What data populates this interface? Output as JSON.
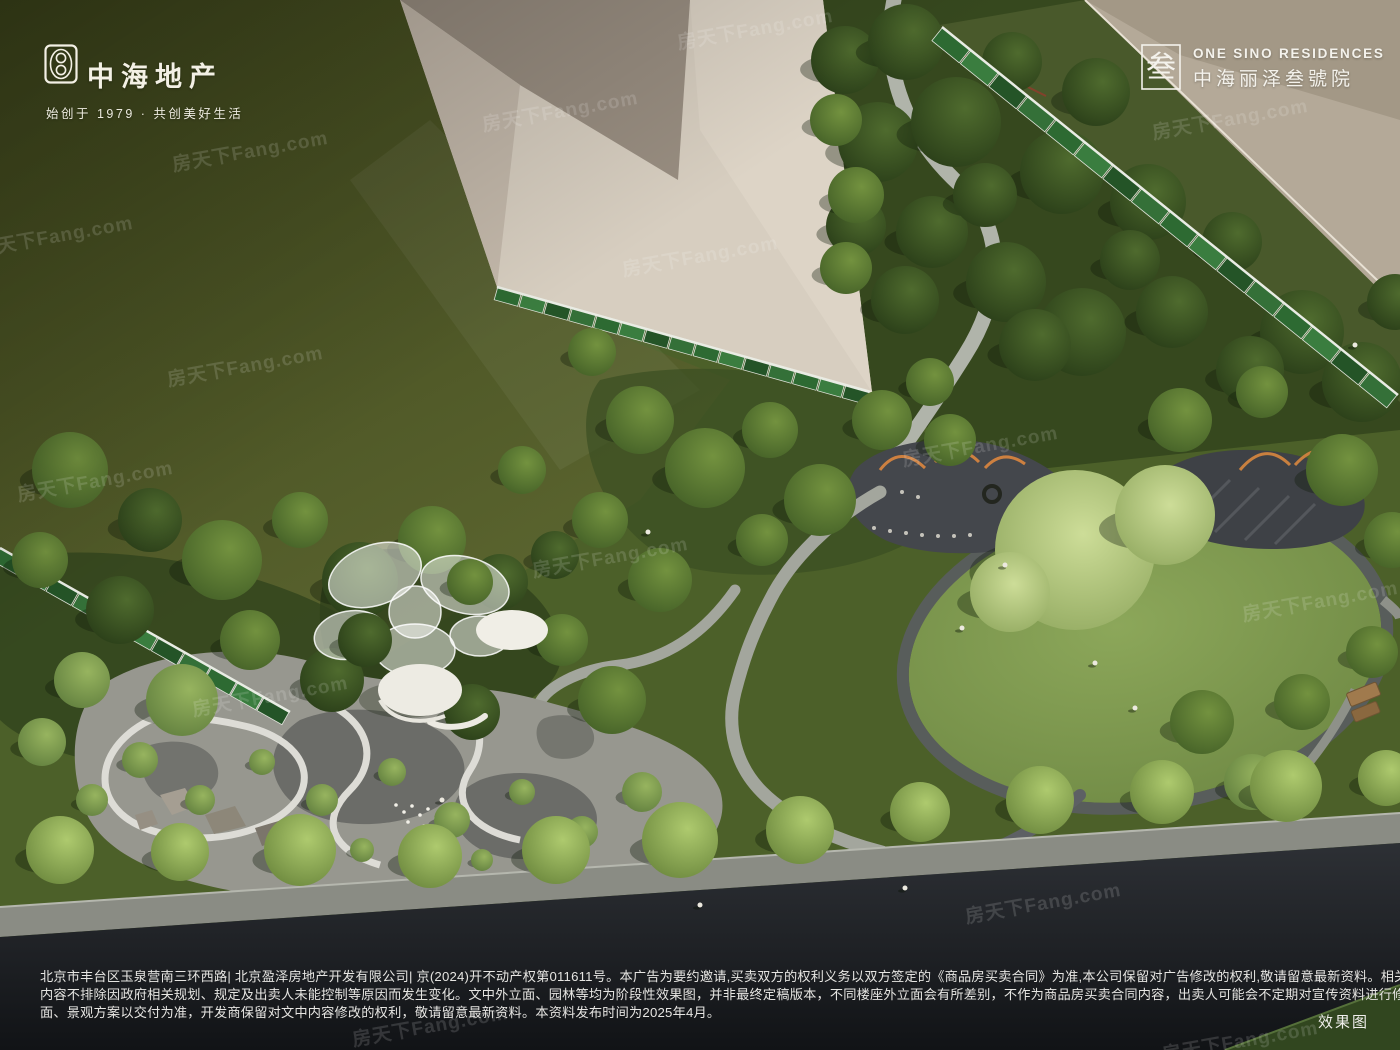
{
  "branding": {
    "developer": {
      "logo": "zhonghai-seal",
      "name": "中海地产",
      "tagline": "始创于 1979 · 共创美好生活"
    },
    "project": {
      "logo_glyph": "叁",
      "name_en": "ONE SINO RESIDENCES",
      "name_cn": "中海丽泽叁號院"
    }
  },
  "watermark": {
    "text": "房天下Fang.com"
  },
  "disclaimer": {
    "lines": [
      "北京市丰台区玉泉营南三环西路| 北京盈泽房地产开发有限公司| 京(2024)开不动产权第011611号。本广告为要约邀请,买卖双方的权利义务以双方签定的《商品房买卖合同》为准,本公司保留对广告修改的权利,敬请留意最新资料。相关市政配套宣传",
      "内容不排除因政府相关规划、规定及出卖人未能控制等原因而发生变化。文中外立面、园林等均为阶段性效果图，并非最终定稿版本，不同楼座外立面会有所差别，不作为商品房买卖合同内容，出卖人可能会不定期对宣传资料进行修改。实际立",
      "面、景观方案以交付为准，开发商保留对文中内容修改的权利，敬请留意最新资料。本资料发布时间为2025年4月。"
    ]
  },
  "footer": {
    "render_label": "效果图"
  },
  "scene": {
    "description": "dusk aerial rendering of landscaped community park",
    "colors": {
      "field_green": "#4d5427",
      "forest_green": "#36481e",
      "lawn_green": "#84a04f",
      "building_cream": "#d7cec0",
      "building_roof": "#998e81",
      "path_light": "#b0b4aa",
      "path_dark": "#54575c",
      "road_asphalt": "#1b1e21",
      "fence_banner_green": "#2d6a32",
      "canopy_white": "#edebe3",
      "playground_orange": "#cd8040"
    }
  }
}
